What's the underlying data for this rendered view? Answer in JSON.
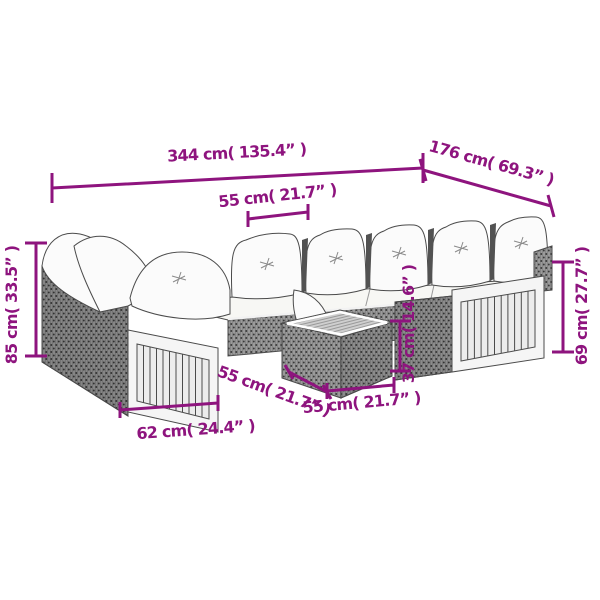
{
  "colors": {
    "dimension": "#8E147E",
    "outline": "#4b4b4b",
    "background": "#ffffff"
  },
  "illustration": {
    "subject": "u-shaped-rattan-garden-sofa-set-with-cushions-and-table"
  },
  "dimensions": {
    "back_width": "344 cm( 135.4” )",
    "depth": "176 cm( 69.3” )",
    "seat_width": "55 cm( 21.7” )",
    "back_height": "85 cm( 33.5” )",
    "arm_height": "69 cm( 27.7” )",
    "table_height": "37 cm( 14.6” )",
    "arm_module_width": "62 cm( 24.4” )",
    "table_depth": "55 cm( 21.7” )",
    "table_width": "55 cm( 21.7” )"
  }
}
